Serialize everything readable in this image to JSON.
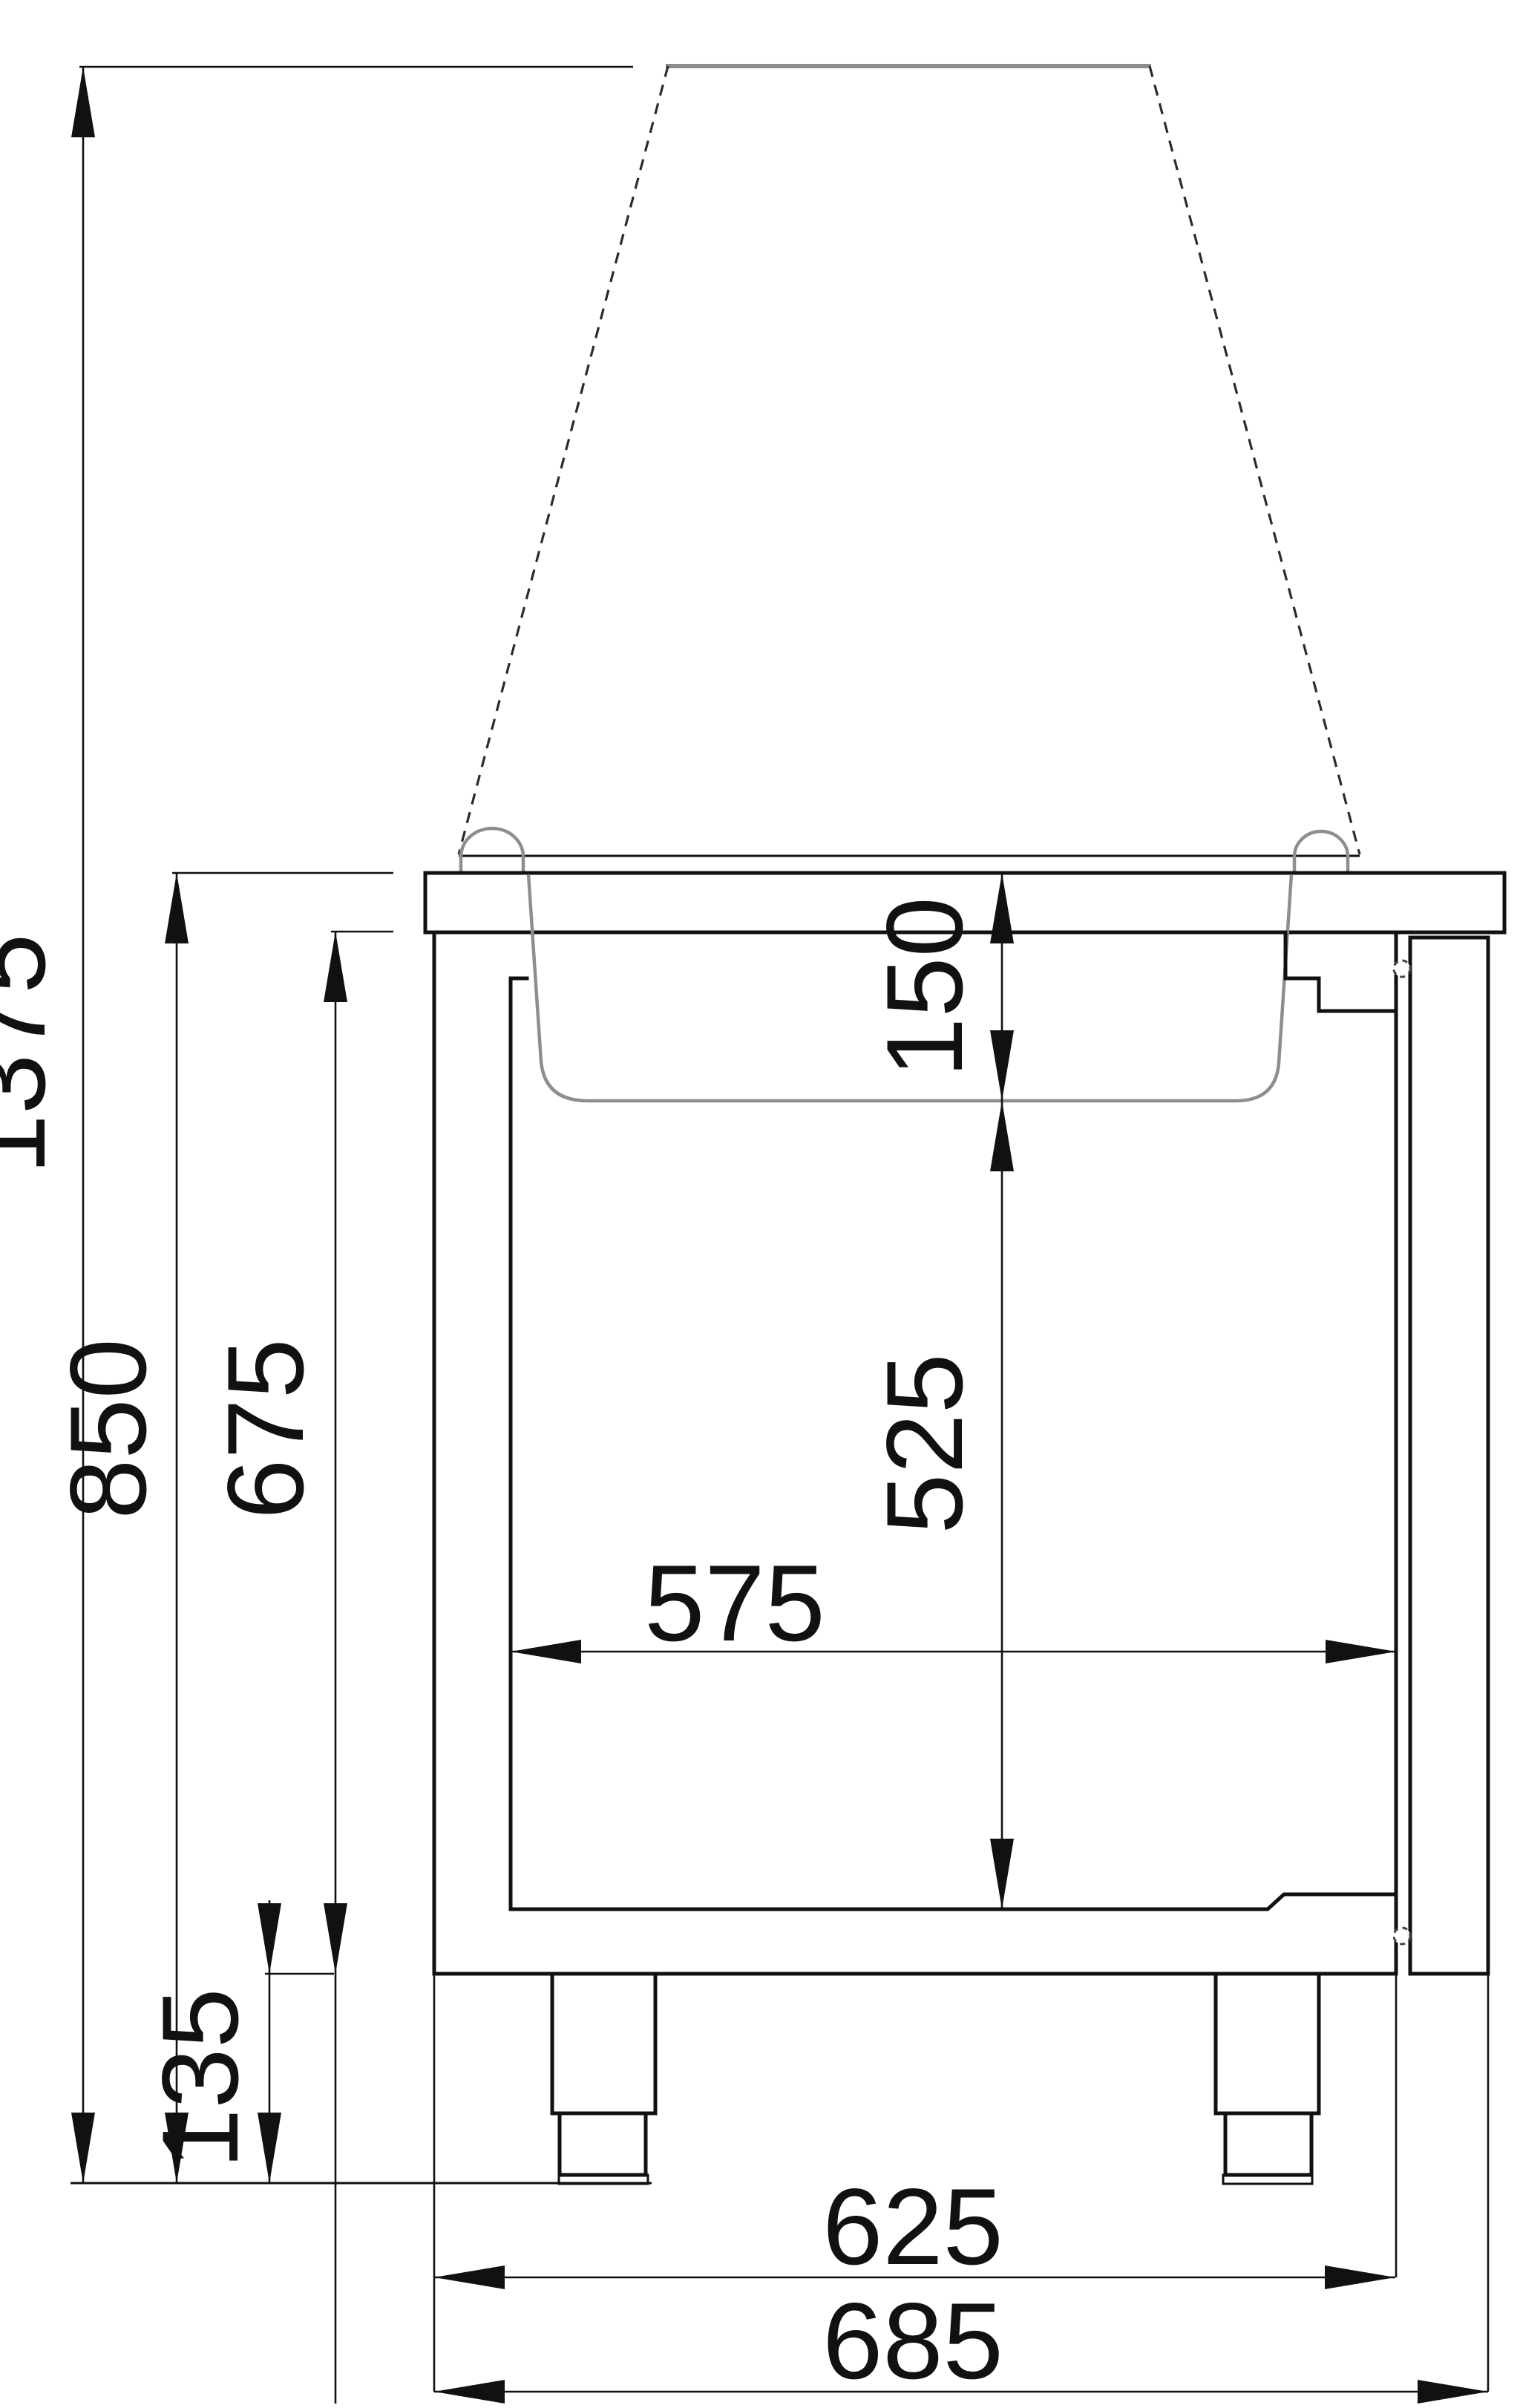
{
  "drawing": {
    "type": "technical-dimension-drawing",
    "view": "side cross-section of refrigerated counter with glass canopy",
    "units_shown": "none (millimetre values only)",
    "colors": {
      "outline": "#111111",
      "secondary_gray": "#8e8e8e",
      "hidden_edge": "#2b2b2b"
    }
  },
  "dimensions": {
    "d1375": {
      "label": "1375",
      "orientation": "vertical",
      "meaning": "overall height incl. canopy"
    },
    "d850": {
      "label": "850",
      "orientation": "vertical",
      "meaning": "floor to worktop surface"
    },
    "d675": {
      "label": "675",
      "orientation": "vertical",
      "meaning": "body height under worktop"
    },
    "d135": {
      "label": "135",
      "orientation": "vertical",
      "meaning": "leg height"
    },
    "d150": {
      "label": "150",
      "orientation": "vertical",
      "meaning": "pan well depth"
    },
    "d525": {
      "label": "525",
      "orientation": "vertical",
      "meaning": "interior clear height"
    },
    "d575": {
      "label": "575",
      "orientation": "horizontal",
      "meaning": "interior clear depth"
    },
    "d625": {
      "label": "625",
      "orientation": "horizontal",
      "meaning": "body depth without door"
    },
    "d685": {
      "label": "685",
      "orientation": "horizontal",
      "meaning": "overall depth with door"
    }
  }
}
